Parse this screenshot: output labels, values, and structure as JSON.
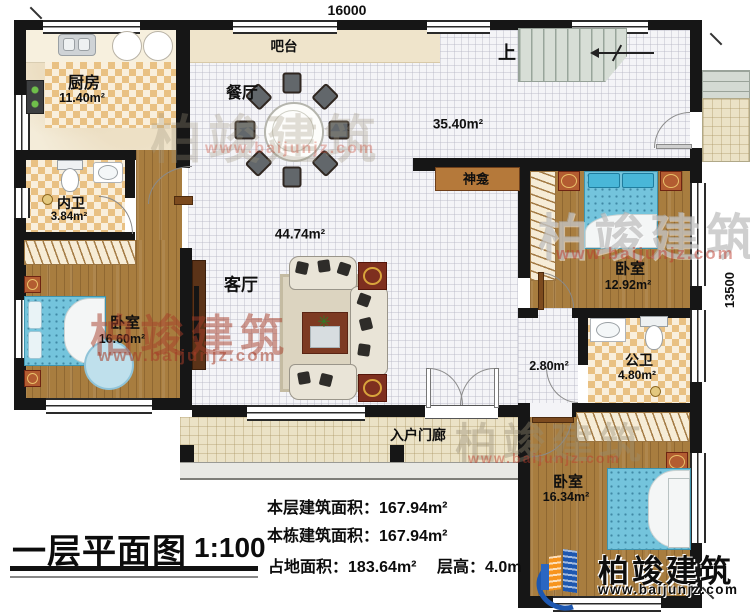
{
  "plan": {
    "title": "一层平面图",
    "scale": "1:100",
    "dims": {
      "width_mm": "16000",
      "height_mm": "13500"
    },
    "rooms": {
      "kitchen": {
        "name": "厨房",
        "area": "11.40m²"
      },
      "bar": {
        "name": "吧台"
      },
      "dining": {
        "name": "餐厅"
      },
      "open_area": {
        "area": "35.40m²"
      },
      "stairs": {
        "up": "上"
      },
      "shrine": {
        "name": "神龛"
      },
      "inner_bath": {
        "name": "内卫",
        "area": "3.84m²"
      },
      "living": {
        "name": "客厅",
        "area": "44.74m²"
      },
      "bedroom_left": {
        "name": "卧室",
        "area": "16.60m²"
      },
      "bedroom_right": {
        "name": "卧室",
        "area": "12.92m²"
      },
      "public_bath": {
        "name": "公卫",
        "area": "4.80m²"
      },
      "hall": {
        "area": "2.80m²"
      },
      "porch": {
        "name": "入户门廊"
      },
      "bedroom_bottom": {
        "name": "卧室",
        "area": "16.34m²"
      }
    },
    "stats": {
      "floor_area_label": "本层建筑面积：",
      "floor_area_value": "167.94m²",
      "building_area_label": "本栋建筑面积：",
      "building_area_value": "167.94m²",
      "land_area_label": "占地面积：",
      "land_area_value": "183.64m²",
      "height_label": "层高：",
      "height_value": "4.0m"
    },
    "branding": {
      "company": "柏竣建筑",
      "website": "www.baijunjz.com"
    },
    "colors": {
      "wall": "#161616",
      "wood": "#a87d3f",
      "checker": "#e9c183",
      "bed_blue": "#74c4dc",
      "logo_blue": "#1d57b0",
      "logo_orange": "#f7941d",
      "watermark_red": "#b5442f"
    }
  }
}
